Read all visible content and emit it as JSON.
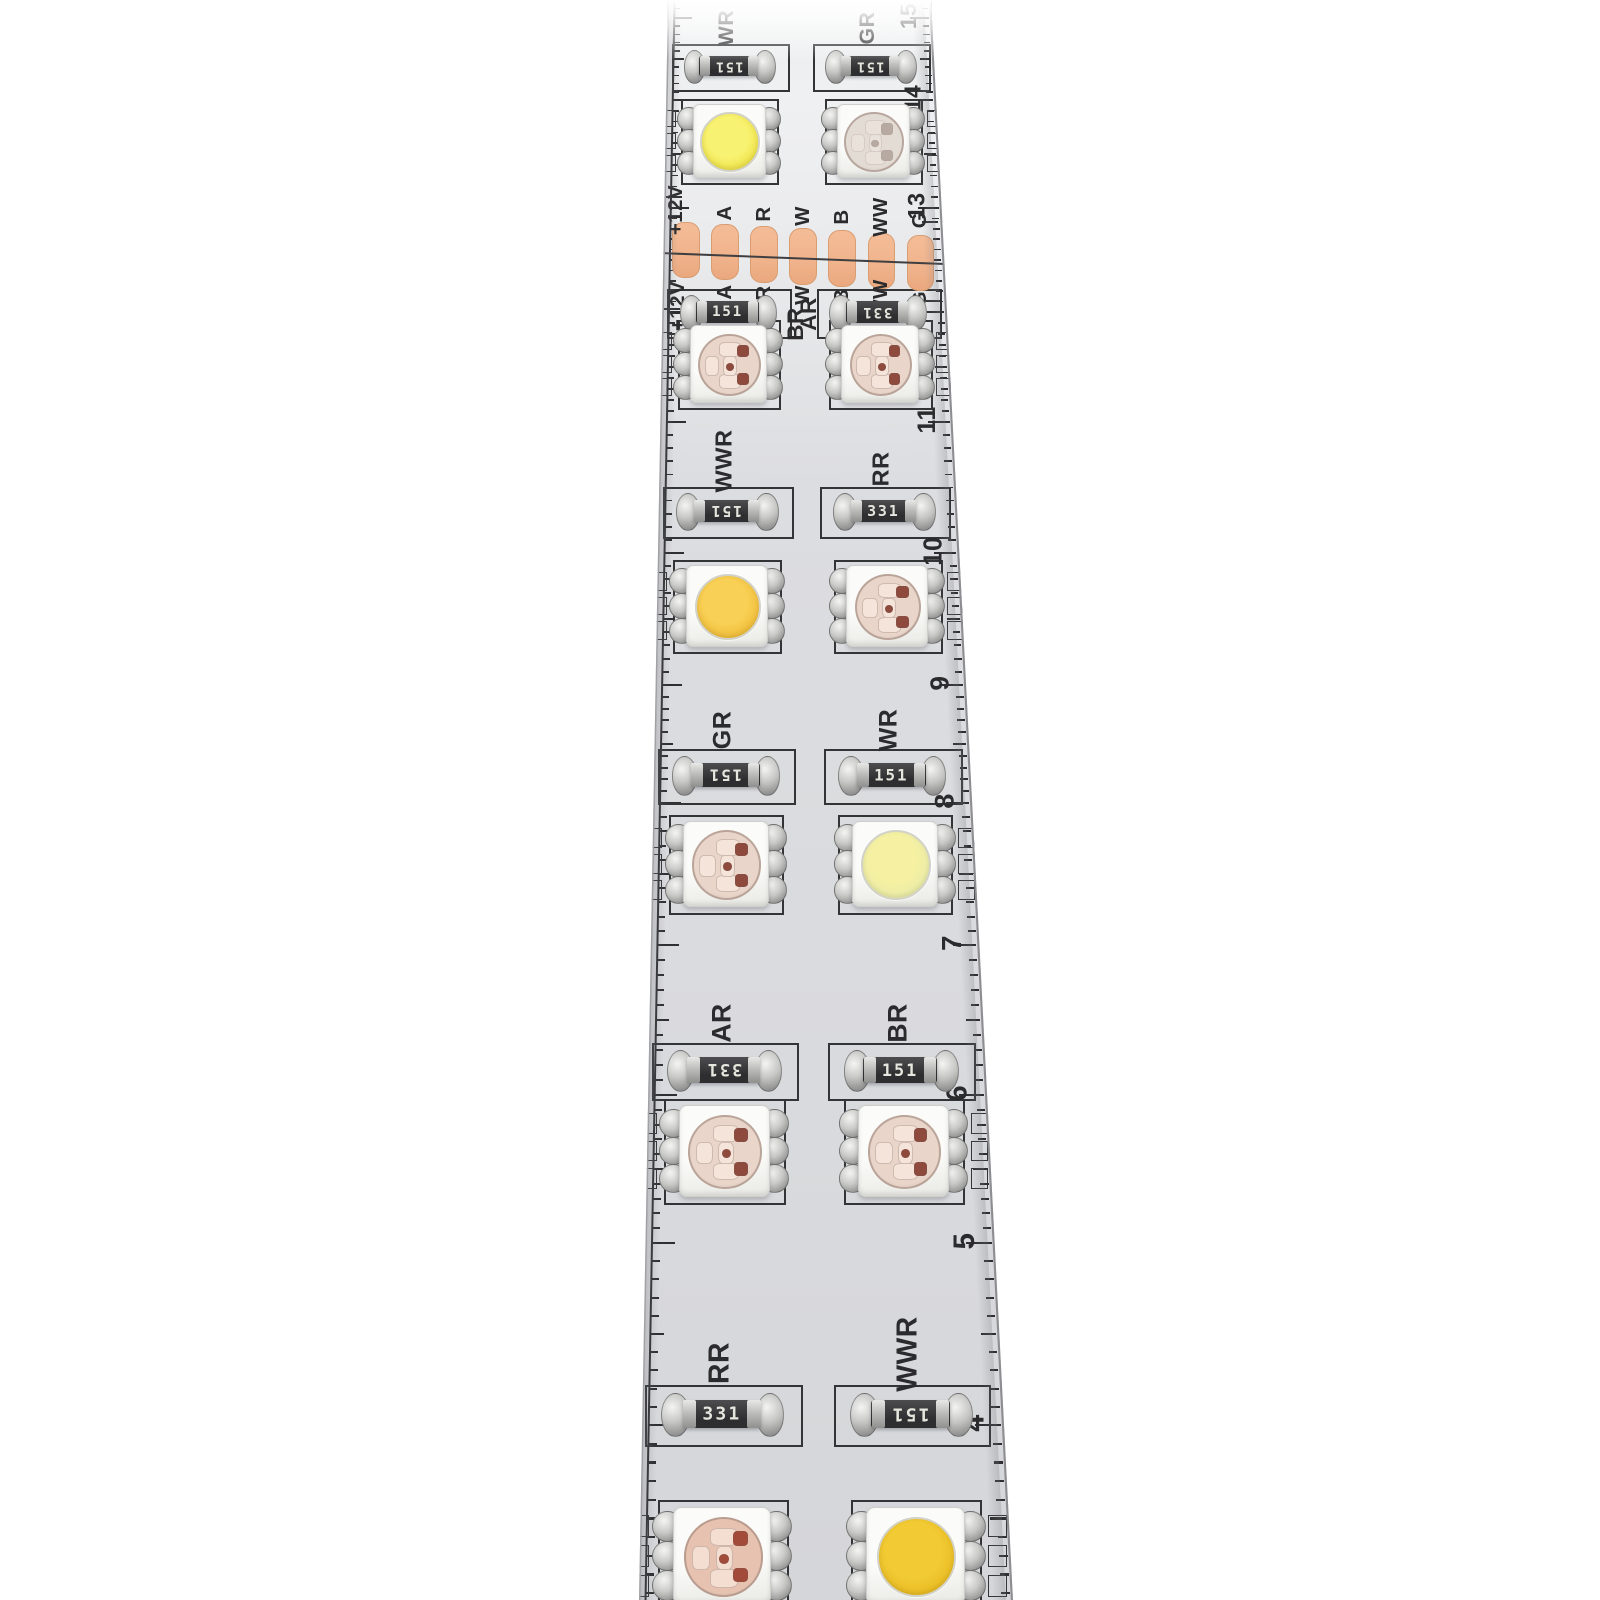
{
  "scene": {
    "background": "#ffffff"
  },
  "strip": {
    "silk_color": "#333436",
    "tick_color": "#2f2f31",
    "text_color": "#2b2b2d",
    "edge_left_color": "#a2a2a6",
    "edge_right_color": "#8e8e92",
    "copper_pad_color": "#f0b38c",
    "copper_pad_edge": "#d99d72",
    "pcb_light": "#e7e8ea",
    "pcb_dark": "#d5d6d9"
  },
  "cut_zone": {
    "labels": [
      "+12V",
      "A",
      "R",
      "W",
      "B",
      "WW",
      "G"
    ]
  },
  "ruler_numbers": [
    {
      "text": "15",
      "y": 18
    },
    {
      "text": "14",
      "y": 100
    },
    {
      "text": "13",
      "y": 208
    },
    {
      "text": "11",
      "y": 422
    },
    {
      "text": "10",
      "y": 553
    },
    {
      "text": "9",
      "y": 685
    },
    {
      "text": "8",
      "y": 803
    },
    {
      "text": "7",
      "y": 945
    },
    {
      "text": "6",
      "y": 1095
    },
    {
      "text": "5",
      "y": 1243
    },
    {
      "text": "4",
      "y": 1425
    }
  ],
  "tick_anchors": [
    -75,
    18,
    100,
    208,
    312,
    422,
    553,
    685,
    803,
    945,
    1095,
    1243,
    1425,
    1612
  ],
  "rows": [
    {
      "type": "resistors",
      "y": 66,
      "left": {
        "label": "WR",
        "value": "151",
        "flip": true,
        "label_pos": "above"
      },
      "right": {
        "label": "GR",
        "value": "151",
        "flip": true,
        "label_pos": "above"
      }
    },
    {
      "type": "leds",
      "y": 140,
      "left": "white",
      "right": "clear"
    },
    {
      "type": "cut",
      "y": 256
    },
    {
      "type": "resistors",
      "y": 312,
      "left": {
        "label": "BR",
        "value": "151",
        "flip": false,
        "label_pos": "right"
      },
      "right": {
        "label": "AR",
        "value": "331",
        "flip": true,
        "label_pos": "left"
      }
    },
    {
      "type": "leds",
      "y": 363,
      "left": "rgb",
      "right": "rgb"
    },
    {
      "type": "resistors",
      "y": 511,
      "left": {
        "label": "WWR",
        "value": "151",
        "flip": true,
        "label_pos": "above"
      },
      "right": {
        "label": "RR",
        "value": "331",
        "flip": false,
        "label_pos": "above"
      }
    },
    {
      "type": "leds",
      "y": 605,
      "left": "warm",
      "right": "rgb"
    },
    {
      "type": "resistors",
      "y": 775,
      "left": {
        "label": "GR",
        "value": "151",
        "flip": true,
        "label_pos": "above"
      },
      "right": {
        "label": "WR",
        "value": "151",
        "flip": false,
        "label_pos": "above"
      }
    },
    {
      "type": "leds",
      "y": 863,
      "left": "rgb",
      "right": "pale"
    },
    {
      "type": "resistors",
      "y": 1070,
      "left": {
        "label": "AR",
        "value": "331",
        "flip": true,
        "label_pos": "above"
      },
      "right": {
        "label": "BR",
        "value": "151",
        "flip": false,
        "label_pos": "above"
      }
    },
    {
      "type": "leds",
      "y": 1150,
      "left": "rgb",
      "right": "rgb"
    },
    {
      "type": "resistors",
      "y": 1414,
      "left": {
        "label": "RR",
        "value": "331",
        "flip": false,
        "label_pos": "above"
      },
      "right": {
        "label": "WWR",
        "value": "151",
        "flip": true,
        "label_pos": "above"
      }
    },
    {
      "type": "leds",
      "y": 1555,
      "left": "rgb_salmon",
      "right": "deep_warm"
    }
  ],
  "led_kinds": {
    "white": {
      "style": "phosphor",
      "center": "#f8f272",
      "edge": "#eadc38"
    },
    "clear": {
      "style": "chips",
      "substrate": "#e3dcd5",
      "pale": "#efe9e2",
      "dark": "#8d7a70",
      "faint": true
    },
    "rgb": {
      "style": "chips",
      "substrate": "#e9d5c9",
      "pale": "#f4e4d9",
      "dark": "#8f4a3e",
      "faint": false
    },
    "warm": {
      "style": "phosphor",
      "center": "#f8d055",
      "edge": "#edb52e"
    },
    "pale": {
      "style": "phosphor",
      "center": "#f5f0a2",
      "edge": "#e6eaaa"
    },
    "rgb_salmon": {
      "style": "chips",
      "substrate": "#e7c2b0",
      "pale": "#f3ded1",
      "dark": "#a34b3a",
      "faint": false
    },
    "deep_warm": {
      "style": "phosphor",
      "center": "#f2cb34",
      "edge": "#e5b51d"
    }
  }
}
